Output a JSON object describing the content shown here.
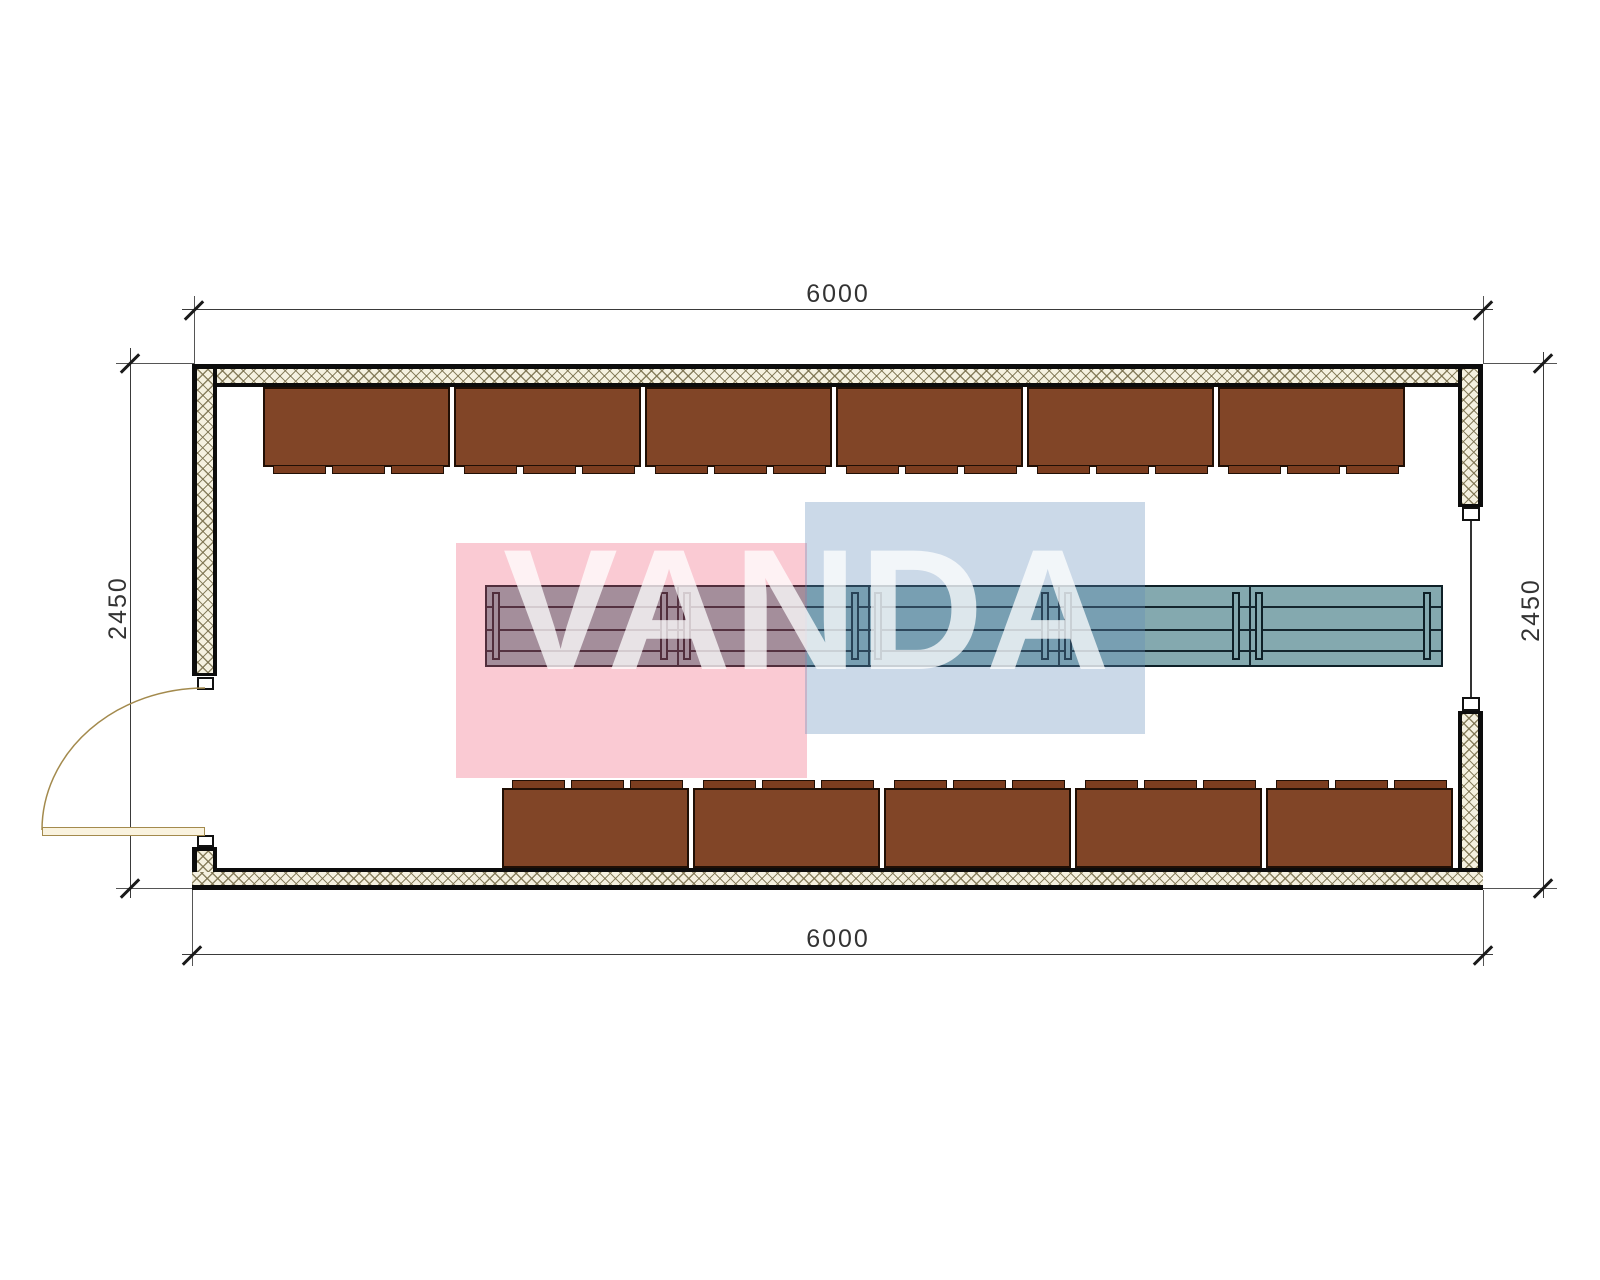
{
  "drawing": {
    "type_label": "cabin-floor-plan",
    "dimensions": {
      "top": "6000",
      "bottom": "6000",
      "left": "2450",
      "right": "2450"
    },
    "watermark": {
      "text": "VANDA",
      "pink_color": "#EE4E6C",
      "blue_color": "#6189B9",
      "text_opacity": 0.75
    },
    "colors": {
      "bench": "#814527",
      "bench_foot": "#7B3D1F",
      "table": "#84A9AF",
      "wall_fill": "#F5F1E0",
      "hatch_line": "#786E4B",
      "outline": "#0C0C0C",
      "door": "#A38A4D"
    },
    "furniture": {
      "top_bench_count": 6,
      "bottom_bench_count": 5,
      "feet_per_bench": 3,
      "table_module_count": 5
    }
  }
}
